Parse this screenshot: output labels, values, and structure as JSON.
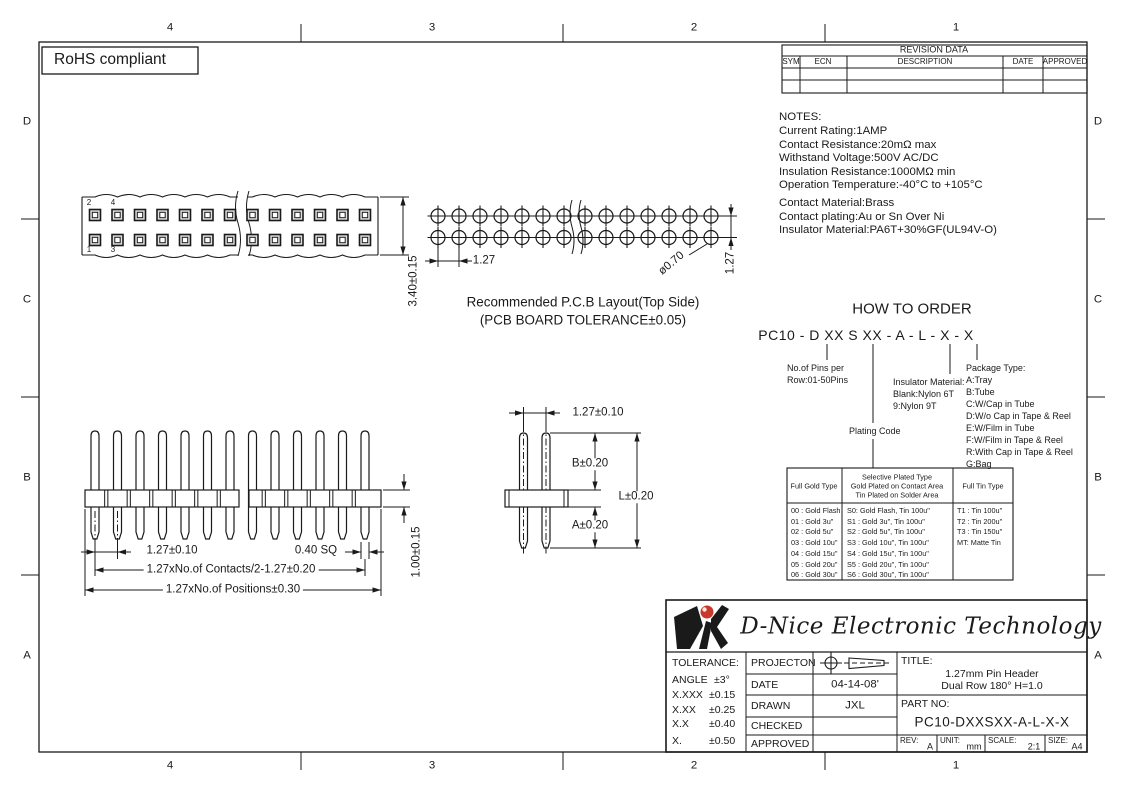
{
  "zones": {
    "top": [
      "4",
      "3",
      "2",
      "1"
    ],
    "bottom": [
      "4",
      "3",
      "2",
      "1"
    ],
    "left": [
      "D",
      "C",
      "B",
      "A"
    ],
    "right": [
      "D",
      "C",
      "B",
      "A"
    ]
  },
  "rohs": {
    "label": "RoHS compliant"
  },
  "revision_table": {
    "title": "REVISION DATA",
    "columns": [
      "SYM",
      "ECN",
      "DESCRIPTION",
      "DATE",
      "APPROVED"
    ]
  },
  "notes": {
    "heading": "NOTES:",
    "electrical": [
      "Current  Rating:1AMP",
      "Contact  Resistance:20mΩ max",
      "Withstand  Voltage:500V  AC/DC",
      "Insulation  Resistance:1000MΩ  min",
      "Operation  Temperature:-40°C  to  +105°C"
    ],
    "material": [
      "Contact  Material:Brass",
      "Contact  plating:Au  or  Sn  Over  Ni",
      "Insulator  Material:PA6T+30%GF(UL94V-O)"
    ]
  },
  "top_view": {
    "pins_per_row": 13,
    "break_after": 7,
    "pin_numbers": [
      "2",
      "4",
      "1",
      "3"
    ],
    "height_dim": "3.40±0.15"
  },
  "pcb_layout": {
    "columns": 14,
    "rows": 2,
    "break_after": 7,
    "pitch_dim": "1.27",
    "hole_dim": "ø0.70",
    "row_dim": "1.27",
    "caption_line1": "Recommended  P.C.B  Layout(Top  Side)",
    "caption_line2": "(PCB  BOARD  TOLERANCE±0.05)"
  },
  "front_view": {
    "pins": 13,
    "break_after": 7,
    "pitch_dim": "1.27±0.10",
    "pin_sq_dim": "0.40  SQ",
    "contacts_dim": "1.27xNo.of  Contacts/2-1.27±0.20",
    "positions_dim": "1.27xNo.of  Positions±0.30",
    "height_dim": "1.00±0.15"
  },
  "side_view": {
    "pitch_dim": "1.27±0.10",
    "b_dim": "B±0.20",
    "l_dim": "L±0.20",
    "a_dim": "A±0.20"
  },
  "how_to_order": {
    "title": "HOW TO ORDER",
    "part_format": "PC10 - D XX S XX - A - L - X - X",
    "pins_note": [
      "No.of Pins per",
      "Row:01-50Pins"
    ],
    "insulator_note": [
      "Insulator Material:",
      "Blank:Nylon 6T",
      "9:Nylon 9T"
    ],
    "plating_note": "Plating Code",
    "package_heading": "Package Type:",
    "package_options": [
      "A:Tray",
      "B:Tube",
      "C:W/Cap in Tube",
      "D:W/o Cap in Tape & Reel",
      "E:W/Film in Tube",
      "F:W/Film in Tape & Reel",
      "R:With Cap in Tape & Reel",
      "G:Bag"
    ]
  },
  "plating_table": {
    "header_gold": "Full Gold Type",
    "header_selective": [
      "Selective Plated Type",
      "Gold Plated on Contact Area",
      "Tin Plated on Solder Area"
    ],
    "header_tin": "Full Tin Type",
    "full_gold": [
      "00 : Gold Flash",
      "01 : Gold 3u\"",
      "02 : Gold 5u\"",
      "03 : Gold 10u\"",
      "04 : Gold 15u\"",
      "05 : Gold 20u\"",
      "06 : Gold 30u\""
    ],
    "selective": [
      "S0: Gold Flash, Tin 100u\"",
      "S1 : Gold 3u\",  Tin 100u\"",
      "S2 : Gold 5u\",  Tin 100u\"",
      "S3 : Gold 10u\", Tin 100u\"",
      "S4 : Gold 15u\", Tin 100u\"",
      "S5 : Gold 20u\", Tin 100u\"",
      "S6 : Gold 30u\", Tin 100u\""
    ],
    "full_tin": [
      "T1 : Tin 100u\"",
      "T2 : Tin 200u\"",
      "T3 : Tin 150u\"",
      "MT: Matte Tin"
    ]
  },
  "title_block": {
    "company": "D-Nice Electronic Technology",
    "tolerance": {
      "heading": "TOLERANCE:",
      "rows": [
        {
          "d": "ANGLE",
          "v": "±3°"
        },
        {
          "d": "X.XXX",
          "v": "±0.15"
        },
        {
          "d": "X.XX",
          "v": "±0.25"
        },
        {
          "d": "X.X",
          "v": "±0.40"
        },
        {
          "d": "X.",
          "v": "±0.50"
        }
      ]
    },
    "fields": [
      {
        "label": "PROJECTON",
        "value": ""
      },
      {
        "label": "DATE",
        "value": "04-14-08'"
      },
      {
        "label": "DRAWN",
        "value": "JXL"
      },
      {
        "label": "CHECKED",
        "value": ""
      },
      {
        "label": "APPROVED",
        "value": ""
      }
    ],
    "title_label": "TITLE:",
    "title_line1": "1.27mm Pin Header",
    "title_line2": "Dual Row 180° H=1.0",
    "part_label": "PART  NO:",
    "part_no": "PC10-DXXSXX-A-L-X-X",
    "rev_label": "REV:",
    "rev": "A",
    "unit_label": "UNIT:",
    "unit": "mm",
    "scale_label": "SCALE:",
    "scale": "2:1",
    "size_label": "SIZE:",
    "size": "A4"
  },
  "colors": {
    "line": "#1a1a1a",
    "logo_red": "#c8392b",
    "pin_fill": "#e0e0e0"
  }
}
